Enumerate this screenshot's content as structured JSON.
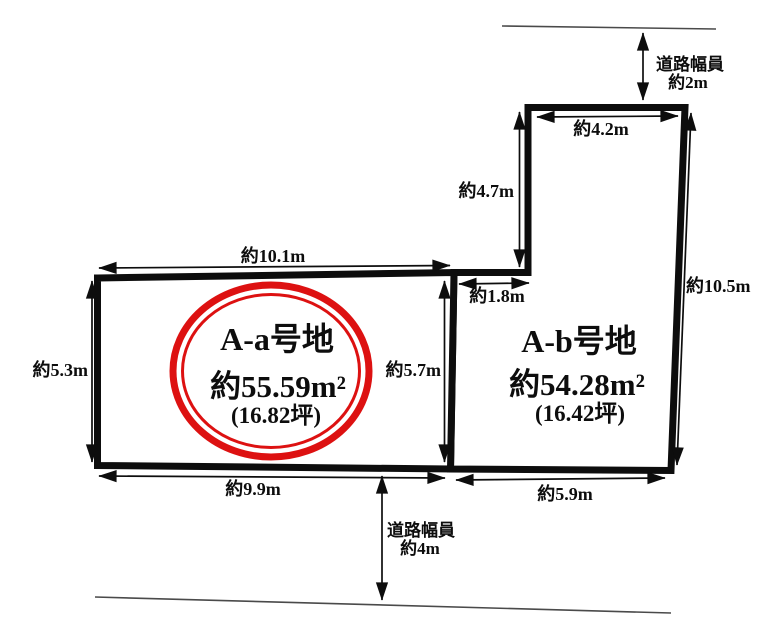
{
  "diagram": {
    "type": "land-plot-layout",
    "parcels": {
      "a": {
        "name": "A-a号地",
        "area": "約55.59m²",
        "tsubo": "(16.82坪)",
        "highlighted": true
      },
      "b": {
        "name": "A-b号地",
        "area": "約54.28m²",
        "tsubo": "(16.42坪)",
        "highlighted": false
      }
    },
    "dimensions": {
      "a_top": "約10.1m",
      "a_left": "約5.3m",
      "a_right": "約5.7m",
      "a_bottom": "約9.9m",
      "b_top": "約4.2m",
      "b_upper_left": "約4.7m",
      "b_right": "約10.5m",
      "b_bottom": "約5.9m",
      "b_step": "約1.8m"
    },
    "roads": {
      "top": {
        "line1": "道路幅員",
        "line2": "約2m"
      },
      "bottom": {
        "line1": "道路幅員",
        "line2": "約4m"
      }
    },
    "colors": {
      "highlight_ring": "#dd1111",
      "outline": "#0d0d0d",
      "road_line": "#4a4a4a",
      "background": "#ffffff"
    }
  }
}
